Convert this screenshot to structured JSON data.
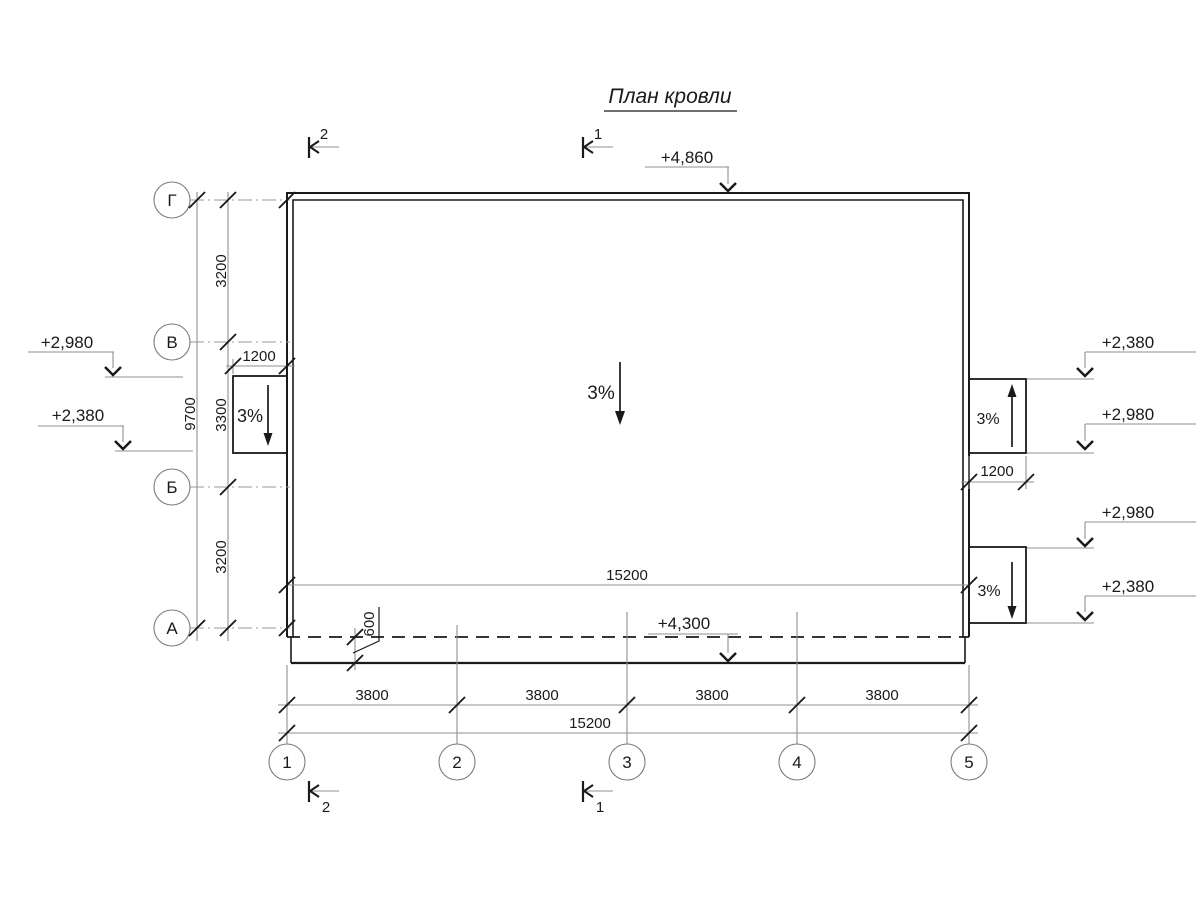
{
  "title": "План кровли",
  "colors": {
    "line": "#1a1a1a",
    "thin_line": "#8f8f8f",
    "axis_line": "#9a9a9a",
    "background": "#ffffff"
  },
  "axes": {
    "rows": [
      "Г",
      "В",
      "Б",
      "А"
    ],
    "cols": [
      "1",
      "2",
      "3",
      "4",
      "5"
    ]
  },
  "sections": {
    "top": [
      "2",
      "1"
    ],
    "bottom": [
      "2",
      "1"
    ]
  },
  "elevations": {
    "top": "+4,860",
    "eaves": "+4,300",
    "left": [
      "+2,980",
      "+2,380"
    ],
    "right": [
      "+2,380",
      "+2,980",
      "+2,980",
      "+2,380"
    ]
  },
  "slopes": {
    "main": "3%",
    "left_canopy": "3%",
    "right_upper": "3%",
    "right_lower": "3%"
  },
  "dims": {
    "left_overall": "9700",
    "left_segments": [
      "3200",
      "3300",
      "3200"
    ],
    "canopy_width": "1200",
    "right_box_width": "1200",
    "roof_width": "15200",
    "overhang": "600",
    "bottom_segments": [
      "3800",
      "3800",
      "3800",
      "3800"
    ],
    "bottom_overall": "15200"
  }
}
